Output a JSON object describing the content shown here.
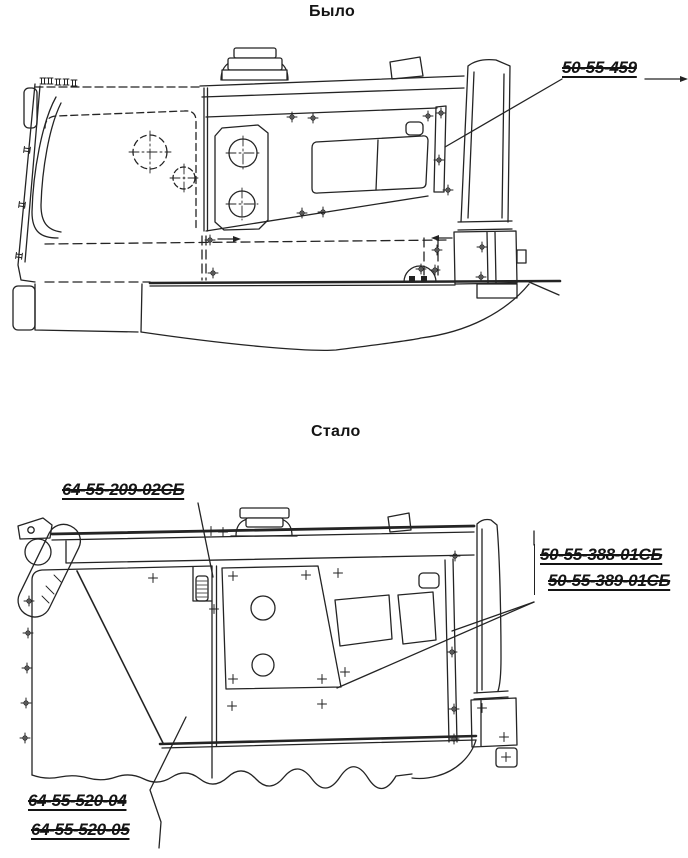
{
  "page": {
    "background": "#ffffff",
    "ink": "#222222"
  },
  "figure_before": {
    "title": "Было",
    "callouts": [
      {
        "part_number": "50-55-459"
      }
    ]
  },
  "figure_after": {
    "title": "Стало",
    "callouts": [
      {
        "part_number": "64-55-209-02СБ"
      },
      {
        "part_number": "50-55-388-01СБ"
      },
      {
        "part_number": "50-55-389-01СБ"
      },
      {
        "part_number": "64-55-520-04"
      },
      {
        "part_number": "64-55-520-05"
      }
    ]
  }
}
